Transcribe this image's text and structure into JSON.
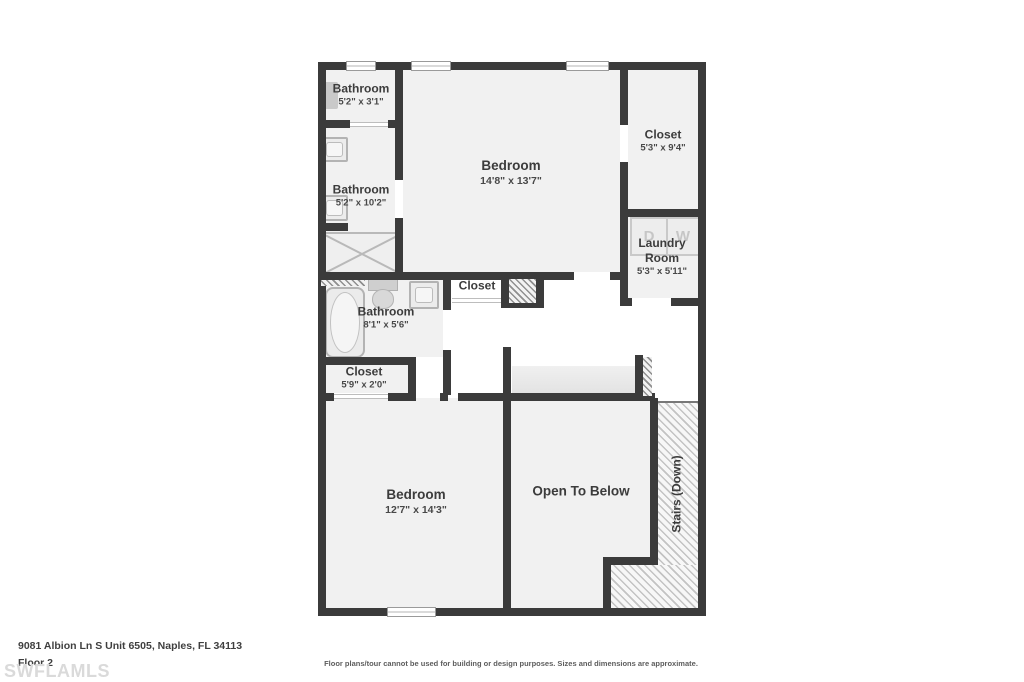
{
  "plan": {
    "rooms": [
      {
        "name": "Bathroom",
        "dims": "5'2\" x 3'1\""
      },
      {
        "name": "Bathroom",
        "dims": "5'2\" x 10'2\""
      },
      {
        "name": "Bedroom",
        "dims": "14'8\" x 13'7\""
      },
      {
        "name": "Closet",
        "dims": "5'3\" x 9'4\""
      },
      {
        "name": "Laundry Room",
        "dims": "5'3\" x 5'11\""
      },
      {
        "name": "Closet",
        "dims": ""
      },
      {
        "name": "Bathroom",
        "dims": "8'1\" x 5'6\""
      },
      {
        "name": "Closet",
        "dims": "5'9\" x 2'0\""
      },
      {
        "name": "Bedroom",
        "dims": "12'7\" x 14'3\""
      },
      {
        "name": "Open To Below",
        "dims": ""
      },
      {
        "name": "Stairs (Down)",
        "dims": ""
      }
    ],
    "appliances": {
      "dryer": "D",
      "washer": "W"
    }
  },
  "footer": {
    "address": "9081 Albion Ln S Unit 6505, Naples, FL 34113",
    "floor": "Floor 2",
    "watermark": "SWFLAMLS",
    "disclaimer": "Floor plans/tour cannot be used for building or design purposes. Sizes and dimensions are approximate."
  },
  "colors": {
    "wall": "#3b3b3b",
    "room_fill": "#f1f1f1",
    "fixture_border": "#b3b3b3",
    "watermark": "#dadada"
  }
}
